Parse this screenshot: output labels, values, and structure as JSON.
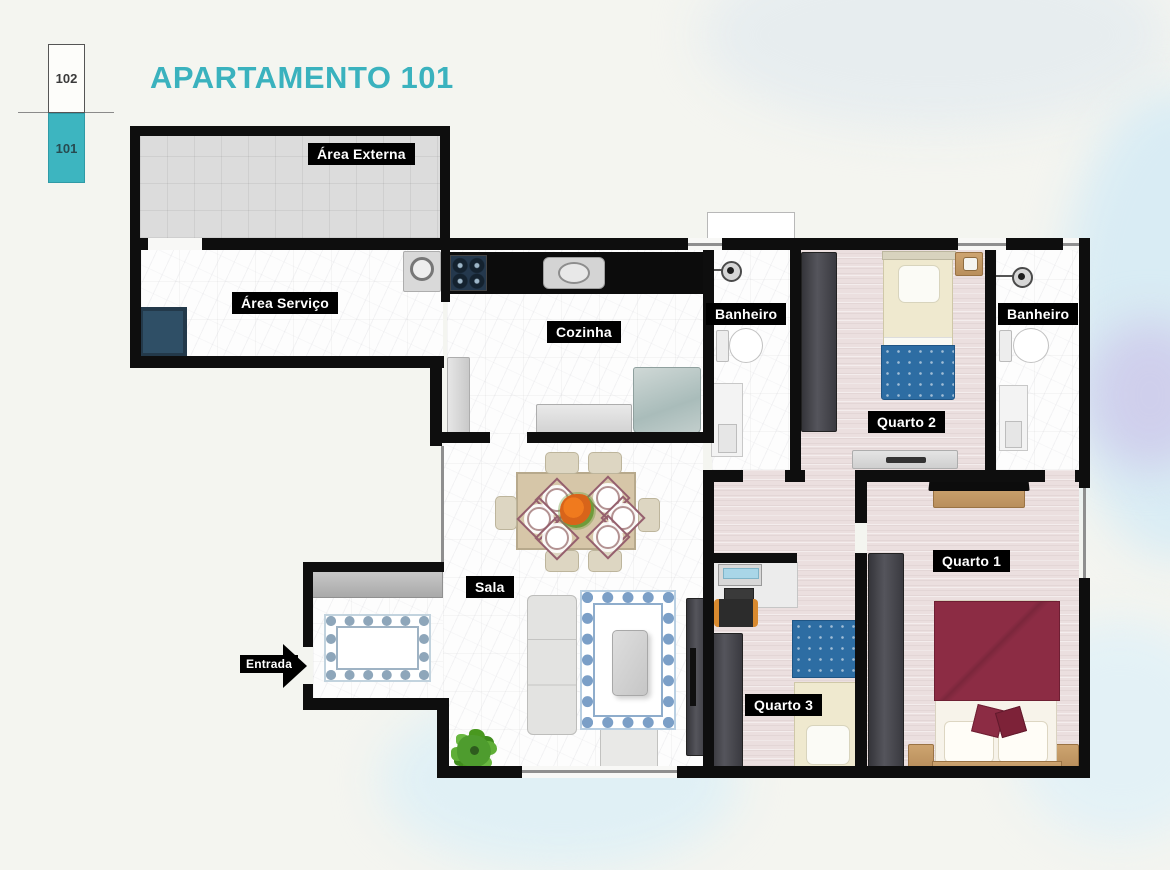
{
  "header": {
    "title": "APARTAMENTO 101"
  },
  "legend": {
    "unit_102": {
      "label": "102"
    },
    "unit_101": {
      "label": "101"
    },
    "active_color": "#3db5c0"
  },
  "floor_plan": {
    "area_externa": {
      "label": "Área Externa"
    },
    "area_servico": {
      "label": "Área Serviço"
    },
    "cozinha": {
      "label": "Cozinha"
    },
    "banheiro_1": {
      "label": "Banheiro"
    },
    "banheiro_2": {
      "label": "Banheiro"
    },
    "quarto_1": {
      "label": "Quarto 1"
    },
    "quarto_2": {
      "label": "Quarto 2"
    },
    "quarto_3": {
      "label": "Quarto 3"
    },
    "sala": {
      "label": "Sala"
    },
    "entrada": {
      "label": "Entrada"
    }
  },
  "colors": {
    "accent_teal": "#3ab2be",
    "wall_black": "#0e0e0e",
    "blanket_blue": "#2d6da3",
    "blanket_maroon": "#8c2c44",
    "bedroom_floor": "#ebdfdf"
  }
}
